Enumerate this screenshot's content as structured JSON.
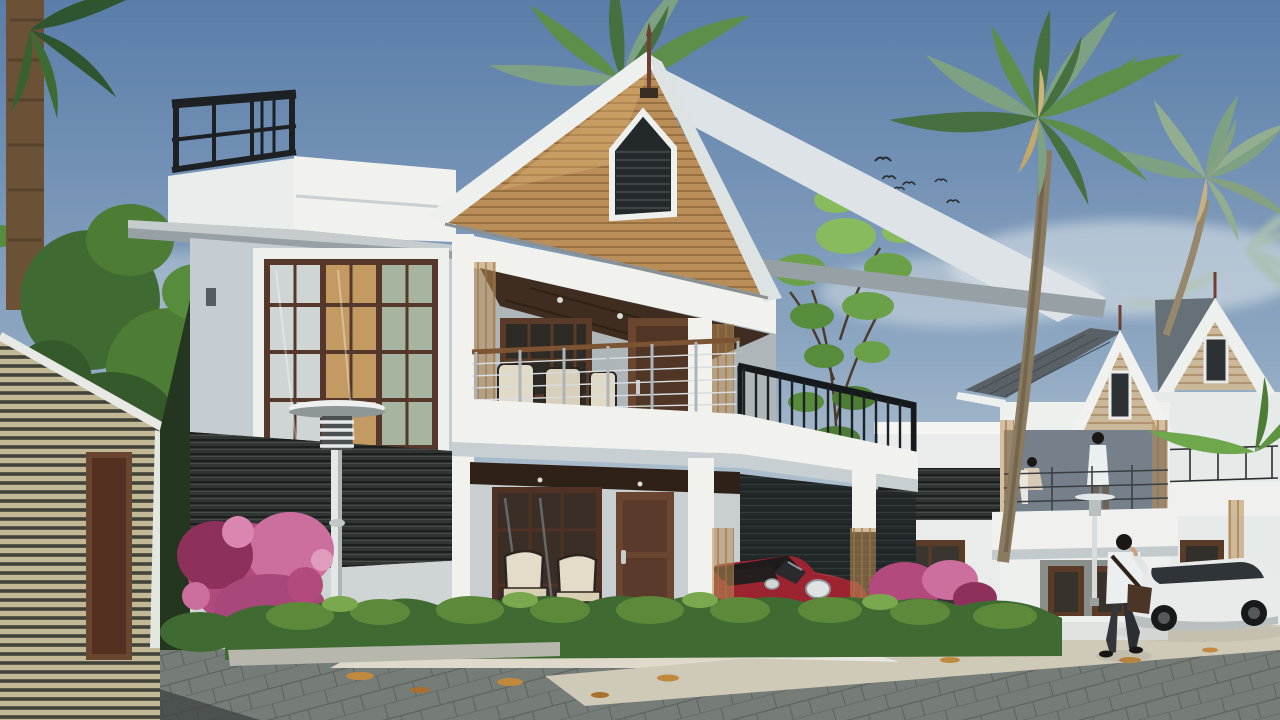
{
  "scene": {
    "type": "3d-architectural-render",
    "subject": "row of modern two-storey tropical villas with palm trees, paved street, parked cars and pedestrians",
    "time_of_day": "day",
    "counts": {
      "villas": 3,
      "birds": 6,
      "cars": 2,
      "people": 3,
      "street_lamps": 2
    }
  },
  "texts": {
    "license_plate": "KL 01 DB1"
  },
  "colors": {
    "sky_top": "#5a7da9",
    "sky_mid": "#8fa8c2",
    "sky_horizon": "#ccd6da",
    "haze": "#e9eeee",
    "wall_bright": "#f1f2ee",
    "wall_light": "#dfe4e6",
    "wall_shade": "#c5cdd2",
    "wall_dark_shade": "#aab4ba",
    "concrete": "#97a0a4",
    "roof_plane": "#dde3e6",
    "wood": "#b98e58",
    "wood_dark": "#8c6539",
    "wood_door": "#6a4631",
    "wood_deep": "#3e2d20",
    "slat_dark": "#303533",
    "vent_dark": "#23282a",
    "railing_black": "#1d2124",
    "cable": "#d7dde0",
    "foliage_dark": "#3f6b33",
    "foliage": "#578c3c",
    "foliage_light": "#79a84e",
    "palm_green": "#5e8f4a",
    "palm_desat": "#7fa183",
    "trunk": "#8a7a5f",
    "car_red": "#9c2430",
    "car_red_hi": "#c23542",
    "car_dark": "#1f1b1a",
    "car_white": "#e9ebea",
    "flower_pink": "#b34a7d",
    "flower_pink_light": "#cd6f9e",
    "pavement": "#767c78",
    "pavement_light": "#cfc9b8",
    "apron": "#ded9cb",
    "leaf_fall": "#c08a3e",
    "lamp": "#e4e7e7",
    "stripe_beige": "#c2b896",
    "shingle": "#596167",
    "gable_beige": "#cbb89a",
    "plate_bg": "#d8dad4",
    "plate_text": "#20242a",
    "shirt_white": "#eceff0",
    "pants": "#33363a",
    "bag": "#4a3526",
    "hair": "#1a1715"
  }
}
